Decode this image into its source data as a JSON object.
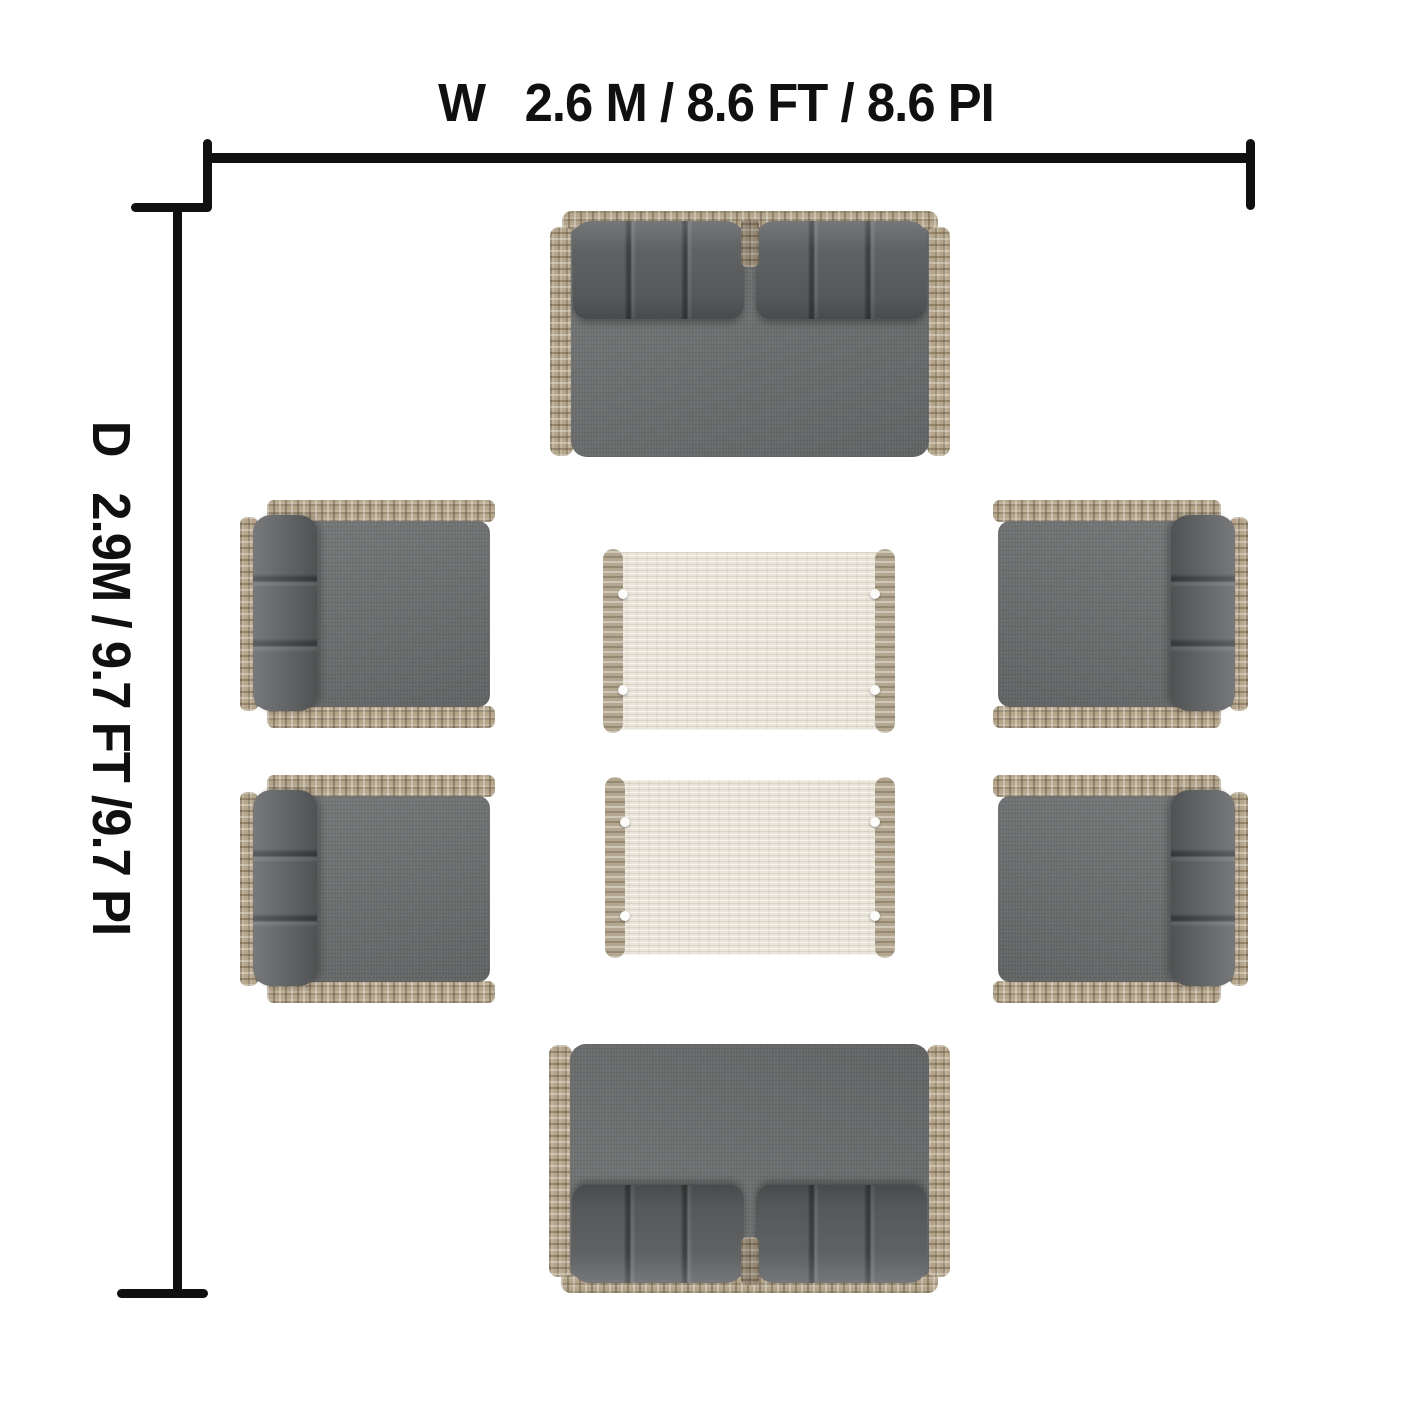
{
  "dimensions": {
    "width": {
      "axis": "W",
      "value": "2.6 M / 8.6 FT / 8.6 PI"
    },
    "depth": {
      "axis": "D",
      "value": "2.9M / 9.7 FT /9.7 PI"
    }
  },
  "colors": {
    "bg": "#ffffff",
    "line": "#101010",
    "wicker": "#b4a58b",
    "cushion": "#6c6e6f",
    "pillow": "#5f6163",
    "tabletop": "#eae5da",
    "tablerail": "#b3a791",
    "foot": "#fcfcfa"
  },
  "furniture": [
    {
      "kind": "loveseat",
      "name": "loveseat-top",
      "x": 550,
      "y": 211,
      "w": 400,
      "h": 247,
      "orient": "up"
    },
    {
      "kind": "loveseat",
      "name": "loveseat-bottom",
      "x": 549,
      "y": 1043,
      "w": 401,
      "h": 250,
      "orient": "down"
    },
    {
      "kind": "armchair",
      "name": "armchair-left-1",
      "x": 240,
      "y": 500,
      "w": 255,
      "h": 228,
      "orient": "left"
    },
    {
      "kind": "armchair",
      "name": "armchair-left-2",
      "x": 240,
      "y": 775,
      "w": 255,
      "h": 228,
      "orient": "left"
    },
    {
      "kind": "armchair",
      "name": "armchair-right-1",
      "x": 993,
      "y": 500,
      "w": 255,
      "h": 228,
      "orient": "right"
    },
    {
      "kind": "armchair",
      "name": "armchair-right-2",
      "x": 993,
      "y": 775,
      "w": 255,
      "h": 228,
      "orient": "right"
    },
    {
      "kind": "table",
      "name": "coffee-table-1",
      "x": 603,
      "y": 549,
      "w": 292,
      "h": 184,
      "orient": "up"
    },
    {
      "kind": "table",
      "name": "coffee-table-2",
      "x": 605,
      "y": 777,
      "w": 290,
      "h": 181,
      "orient": "up"
    }
  ]
}
